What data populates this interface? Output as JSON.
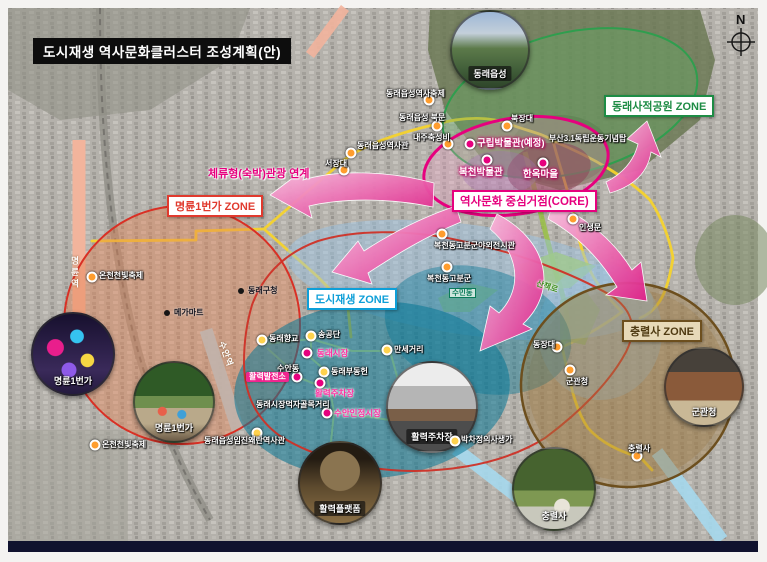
{
  "title": "도시재생 역사문화클러스터 조성계획(안)",
  "compass": {
    "label": "N"
  },
  "legend_zones": {
    "dongnae_park": {
      "label": "동래사적공원 ZONE",
      "color": "#1e8c45"
    },
    "myeongnyun": {
      "label": "명륜1번가 ZONE",
      "color": "#e03a2e"
    },
    "regen": {
      "label": "도시재생 ZONE",
      "color": "#0e9fd8"
    },
    "chungnyeolsa": {
      "label": "충렬사 ZONE",
      "color": "#6d4f1e"
    },
    "core": {
      "label": "역사문화 중심거점(CORE)",
      "color": "#e6007e"
    }
  },
  "core_link": {
    "label": "체류형(숙박)관광 연계"
  },
  "colors": {
    "core_accent": "#e6007e",
    "route_yellow": "#f6d32d",
    "regen_teal": "#087696",
    "zone_green": "#2f9e4e",
    "zone_red": "#d93025",
    "zone_brown": "#6d4f1e"
  },
  "pois": [
    {
      "label": "동래읍성역사축제",
      "x": 386,
      "y": 90,
      "style": "white",
      "dot": {
        "x": 429,
        "y": 100,
        "c": "orange"
      }
    },
    {
      "label": "동래읍성 북문",
      "x": 399,
      "y": 114,
      "style": "white",
      "dot": {
        "x": 437,
        "y": 126,
        "c": "orange"
      }
    },
    {
      "label": "내주축성비",
      "x": 413,
      "y": 134,
      "style": "white",
      "dot": {
        "x": 448,
        "y": 144,
        "c": "orange"
      }
    },
    {
      "label": "동래읍성역사관",
      "x": 357,
      "y": 142,
      "style": "white",
      "dot": {
        "x": 351,
        "y": 153,
        "c": "orange"
      }
    },
    {
      "label": "서장대",
      "x": 325,
      "y": 160,
      "style": "white",
      "dot": {
        "x": 344,
        "y": 170,
        "c": "orange"
      }
    },
    {
      "label": "북장대",
      "x": 511,
      "y": 115,
      "style": "white",
      "dot": {
        "x": 507,
        "y": 126,
        "c": "orange"
      }
    },
    {
      "label": "부산3.1독립운동기념탑",
      "x": 549,
      "y": 135,
      "style": "white"
    },
    {
      "label": "인생문",
      "x": 579,
      "y": 224,
      "style": "white",
      "dot": {
        "x": 573,
        "y": 219,
        "c": "orange"
      }
    },
    {
      "label": "온천천빛축제",
      "x": 99,
      "y": 272,
      "style": "white",
      "dot": {
        "x": 92,
        "y": 277,
        "c": "orange"
      }
    },
    {
      "label": "동래구청",
      "x": 248,
      "y": 287,
      "style": "black",
      "dot": {
        "x": 241,
        "y": 291,
        "c": "black"
      }
    },
    {
      "label": "메가마트",
      "x": 174,
      "y": 309,
      "style": "black",
      "dot": {
        "x": 167,
        "y": 313,
        "c": "black"
      }
    },
    {
      "label": "동래향교",
      "x": 269,
      "y": 335,
      "style": "white",
      "dot": {
        "x": 262,
        "y": 340,
        "c": "yellow"
      }
    },
    {
      "label": "송공단",
      "x": 318,
      "y": 331,
      "style": "white",
      "dot": {
        "x": 311,
        "y": 336,
        "c": "yellow"
      }
    },
    {
      "label": "동래시장",
      "x": 317,
      "y": 349,
      "style": "pink",
      "dot": {
        "x": 307,
        "y": 353,
        "c": "magenta"
      }
    },
    {
      "label": "수안동",
      "x": 277,
      "y": 365,
      "style": "white"
    },
    {
      "label": "활력발전소",
      "x": 246,
      "y": 372,
      "style": "pinkbox",
      "dot": {
        "x": 297,
        "y": 377,
        "c": "magenta"
      }
    },
    {
      "label": "동래부동헌",
      "x": 331,
      "y": 368,
      "style": "white",
      "dot": {
        "x": 324,
        "y": 372,
        "c": "yellow"
      }
    },
    {
      "label": "활력주차장",
      "x": 315,
      "y": 389,
      "style": "pink",
      "dot": {
        "x": 320,
        "y": 383,
        "c": "magenta"
      }
    },
    {
      "label": "동래시장먹자골목거리",
      "x": 256,
      "y": 401,
      "style": "white"
    },
    {
      "label": "수안인정시장",
      "x": 334,
      "y": 409,
      "style": "pink",
      "dot": {
        "x": 327,
        "y": 413,
        "c": "magenta"
      }
    },
    {
      "label": "만세거리",
      "x": 394,
      "y": 346,
      "style": "white",
      "dot": {
        "x": 387,
        "y": 350,
        "c": "yellow"
      }
    },
    {
      "label": "복천동고분군야외전시관",
      "x": 434,
      "y": 242,
      "style": "white",
      "dot": {
        "x": 442,
        "y": 234,
        "c": "orange"
      }
    },
    {
      "label": "복천동고분군",
      "x": 427,
      "y": 275,
      "style": "white",
      "dot": {
        "x": 447,
        "y": 267,
        "c": "orange"
      }
    },
    {
      "label": "수민동",
      "x": 449,
      "y": 288,
      "style": "tealbox"
    },
    {
      "label": "산책로",
      "x": 536,
      "y": 283,
      "style": "green",
      "rot": 18
    },
    {
      "label": "동장대",
      "x": 533,
      "y": 341,
      "style": "white",
      "dot": {
        "x": 557,
        "y": 347,
        "c": "orange"
      }
    },
    {
      "label": "군관청",
      "x": 566,
      "y": 378,
      "style": "white",
      "dot": {
        "x": 570,
        "y": 370,
        "c": "orange"
      }
    },
    {
      "label": "충렬사",
      "x": 628,
      "y": 445,
      "style": "white",
      "dot": {
        "x": 637,
        "y": 456,
        "c": "orange"
      }
    },
    {
      "label": "박차정의사생가",
      "x": 461,
      "y": 436,
      "style": "white",
      "dot": {
        "x": 455,
        "y": 441,
        "c": "yellow"
      }
    },
    {
      "label": "동래읍성임진왜란역사관",
      "x": 204,
      "y": 437,
      "style": "white",
      "dot": {
        "x": 257,
        "y": 433,
        "c": "yellow"
      }
    },
    {
      "label": "온천천빛축제",
      "x": 102,
      "y": 441,
      "style": "white",
      "dot": {
        "x": 95,
        "y": 445,
        "c": "orange"
      }
    },
    {
      "label": "구립박물관(예정)",
      "x": 477,
      "y": 139,
      "style": "core",
      "dot": {
        "x": 470,
        "y": 144,
        "c": "magenta"
      }
    },
    {
      "label": "복천박물관",
      "x": 459,
      "y": 168,
      "style": "core",
      "dot": {
        "x": 487,
        "y": 160,
        "c": "magenta"
      }
    },
    {
      "label": "한옥마을",
      "x": 523,
      "y": 170,
      "style": "core",
      "dot": {
        "x": 543,
        "y": 163,
        "c": "magenta"
      }
    }
  ],
  "transit_labels": [
    {
      "label": "명륜역",
      "x": 69,
      "y": 256,
      "vertical": true
    },
    {
      "label": "수안역",
      "x": 213,
      "y": 348,
      "rot": 70
    }
  ],
  "photos": [
    {
      "caption": "동래읍성",
      "cx": 488,
      "cy": 48,
      "r": 38,
      "style": "eupseong",
      "pill": true
    },
    {
      "caption": "명륜1번가",
      "cx": 71,
      "cy": 352,
      "r": 40,
      "style": "night",
      "pill": false
    },
    {
      "caption": "명륜1번가",
      "cx": 172,
      "cy": 400,
      "r": 39,
      "style": "street",
      "pill": false
    },
    {
      "caption": "활력주차장",
      "cx": 430,
      "cy": 405,
      "r": 44,
      "style": "parking",
      "pill": true
    },
    {
      "caption": "활력플랫폼",
      "cx": 338,
      "cy": 481,
      "r": 40,
      "style": "platform",
      "pill": true
    },
    {
      "caption": "군관청",
      "cx": 702,
      "cy": 385,
      "r": 38,
      "style": "gwan",
      "pill": false
    },
    {
      "caption": "충렬사",
      "cx": 552,
      "cy": 487,
      "r": 40,
      "style": "chung",
      "pill": false
    }
  ]
}
